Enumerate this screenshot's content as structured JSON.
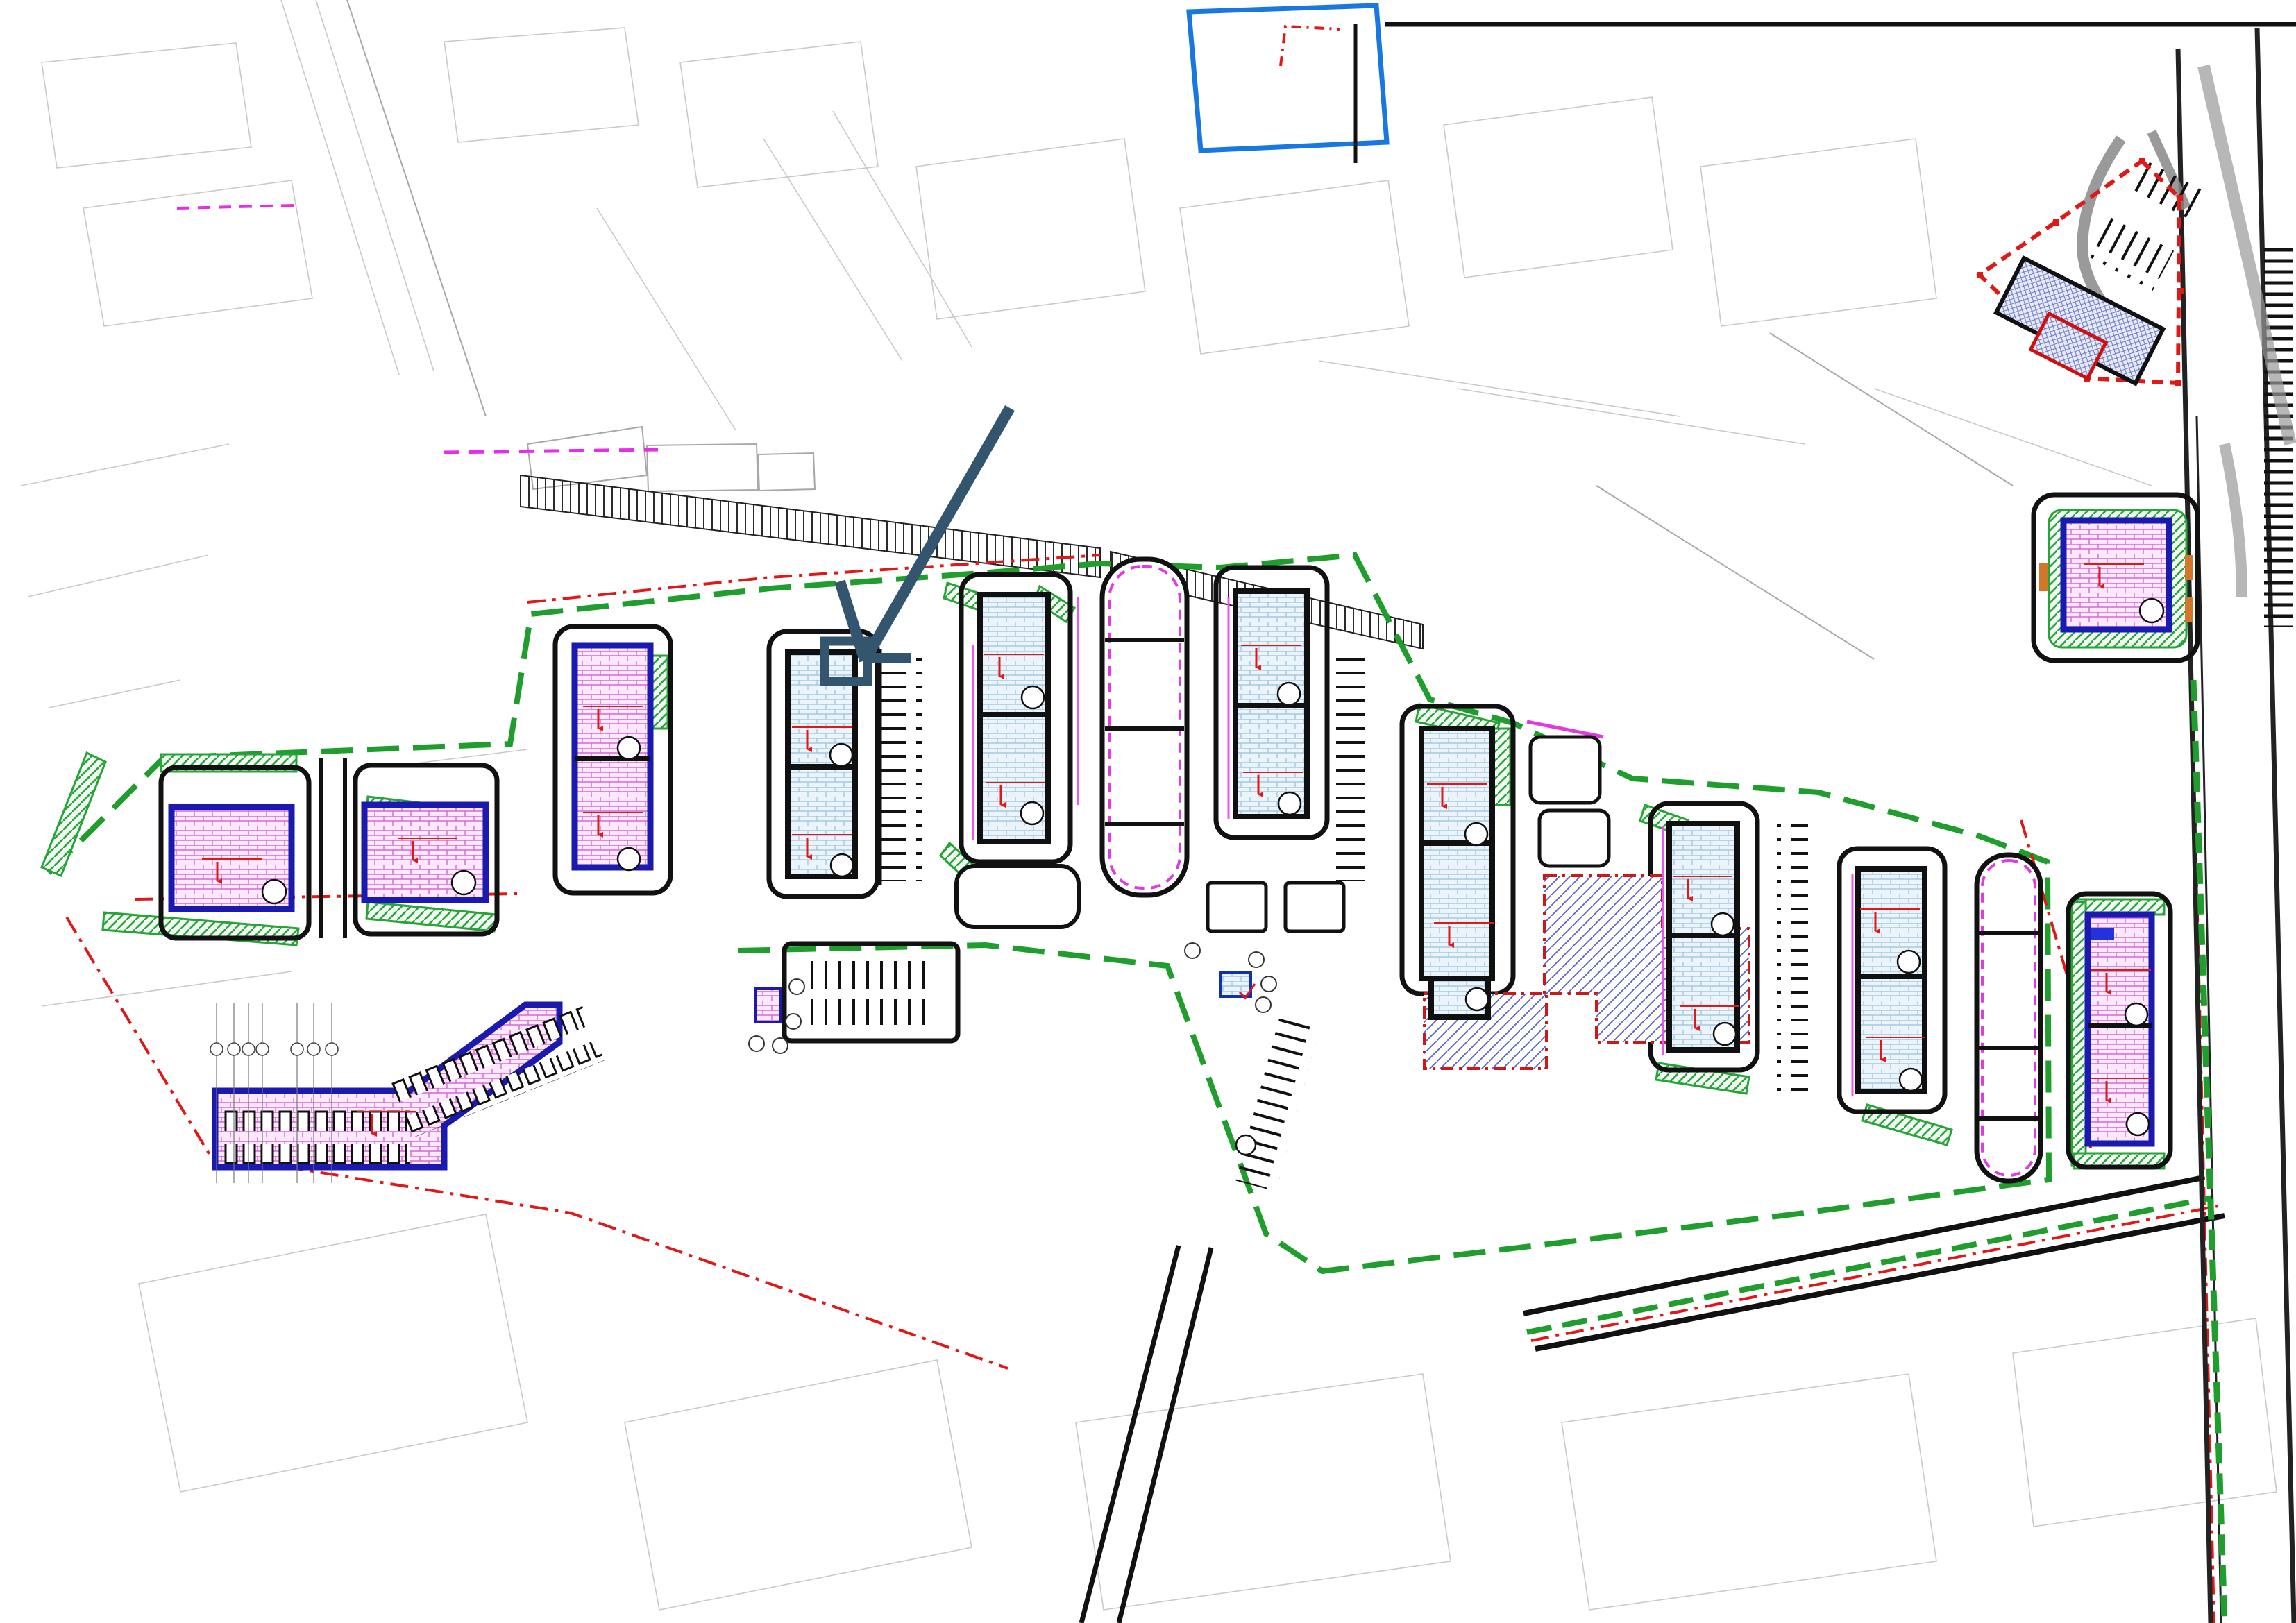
{
  "title": "Лисаветинська , 2 б",
  "labels": {
    "center": "Центр",
    "metro": "Метро Гагаріна",
    "watermark": "novostroy-kharkov.com",
    "soil_dump_line1": "отвал",
    "soil_dump_line2": "грунта",
    "area_222": "222 м²",
    "mv_bottom": "МВ",
    "mv_left": "МВ",
    "md_under5": "МД",
    "mg_magenta": "МГ",
    "mg_black": "МГ",
    "kn_a": "КН",
    "kn_b": "КН",
    "n": "Н"
  },
  "zones": {
    "colA": [
      "МФ",
      "МД",
      "МД",
      "МВ"
    ],
    "colD": [
      "МД",
      "МД",
      "МВ",
      "МФ"
    ],
    "right_of_3": [
      "МД",
      "МФ"
    ],
    "small_boxes": [
      "МФ",
      "МД"
    ]
  },
  "buildings": [
    {
      "label": "9",
      "elev": "106.80"
    },
    {
      "label": "8",
      "elev": "106.80"
    },
    {
      "label": "7.2",
      "elev": "107.05"
    },
    {
      "label": "7.1",
      "elev": "107.05"
    },
    {
      "label": "6.2",
      "elev": "107.25"
    },
    {
      "label": "6.1",
      "elev": "107.25"
    },
    {
      "label": "5.1",
      "elev": "107.05"
    },
    {
      "label": "5.2",
      "elev": "107.05"
    },
    {
      "label": "4.2",
      "elev": "107.05"
    },
    {
      "label": "4.1",
      "elev": "107.05"
    },
    {
      "label": "3.2",
      "elev": "107.05"
    },
    {
      "label": "3.1",
      "elev": "107.05",
      "big": "3"
    },
    {
      "label": "2.2",
      "elev": "107,05"
    },
    {
      "label": "2.1",
      "elev": "107,05"
    },
    {
      "label": "1.2",
      "elev": "107,05"
    },
    {
      "label": "1.1",
      "elev": "107,05"
    },
    {
      "label": "11.2",
      "elev": "106.80"
    },
    {
      "label": "11.1",
      "elev": "106.80"
    },
    {
      "label": "10",
      "elev": "106.95"
    }
  ],
  "structures": {
    "garage_elev": "106.00",
    "sub_pink_elev": "105.65",
    "sub_blue_elev": "105.10",
    "sub_blue_num": "9"
  },
  "parking_labels": {
    "p26": "26 м/м",
    "p13": "13 м/м",
    "p15": "15 м/м",
    "p10": "10 м/м",
    "p7": "7 м/м",
    "p8": "8 м/м",
    "p6": "6 м/м"
  },
  "dimensions": {
    "d1": "10.50",
    "d2": "39.50",
    "d3": "7.45",
    "d4": "8.10",
    "d5": "14.00",
    "d6": "6.00",
    "d7": "9.25",
    "d8": "17.70",
    "d9": "29.30"
  },
  "tr_labels": {
    "red_elev": "104.20",
    "black_elev": "103.40",
    "black_elev2": "105.40"
  },
  "spot_elevations": [
    "129-2-б",
    "103.58",
    "104.36",
    "103.78",
    "104.96",
    "105.40",
    "104.57",
    "103.29",
    "104.12",
    "103.81",
    "105.11",
    "106.15",
    "104.10",
    "103.44",
    "102.67",
    "103.90",
    "104.05",
    "106.61",
    "103.51",
    "104.89",
    "103.74",
    "106.14",
    "104.33",
    "103.56",
    "105.01"
  ],
  "bubbles": {
    "b8": "8",
    "b4": "4",
    "b1": "1",
    "ba": "А",
    "bv": "В"
  },
  "icons": {
    "wheelchair": "♿",
    "cross": "✕",
    "tree": "✳"
  }
}
